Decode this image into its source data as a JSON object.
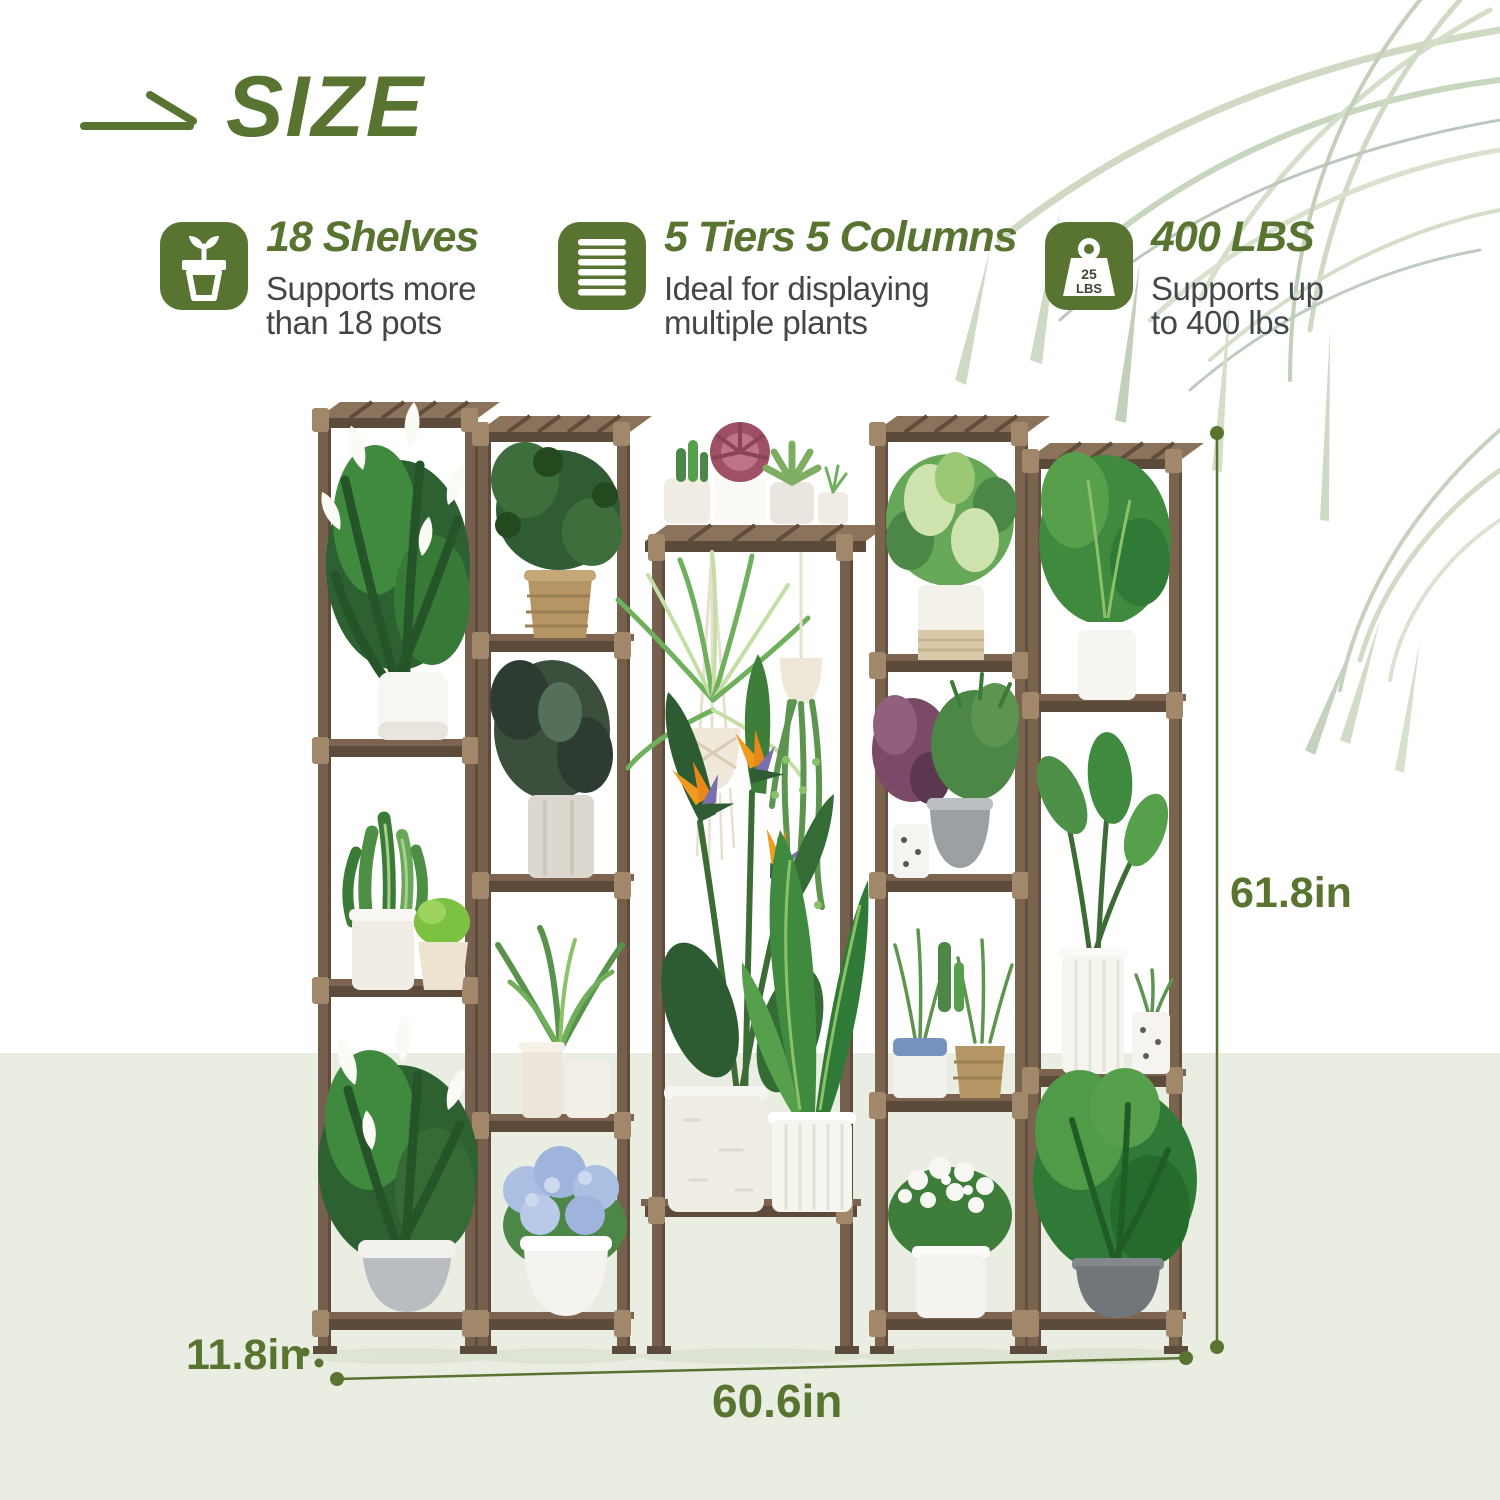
{
  "header": {
    "title": "SIZE",
    "icon": "arrow-icon"
  },
  "features": [
    {
      "icon": "plant-pot-icon",
      "title": "18 Shelves",
      "desc_line1": "Supports more",
      "desc_line2": "than 18 pots"
    },
    {
      "icon": "shelf-tiers-icon",
      "title": "5 Tiers 5 Columns",
      "desc_line1": "Ideal for displaying",
      "desc_line2": "multiple plants"
    },
    {
      "icon": "weight-icon",
      "icon_badge_line1": "25",
      "icon_badge_line2": "LBS",
      "title": "400 LBS",
      "desc_line1": "Supports up",
      "desc_line2": "to 400 lbs"
    }
  ],
  "dimensions": {
    "height": "61.8in",
    "depth": "11.8in",
    "width": "60.6in"
  },
  "colors": {
    "accent_green": "#597431",
    "text_gray": "#42474a",
    "band_green": "#e9ede2",
    "wood_brown": "#6e5847",
    "palm_pale_green": "#c9d7bd"
  }
}
